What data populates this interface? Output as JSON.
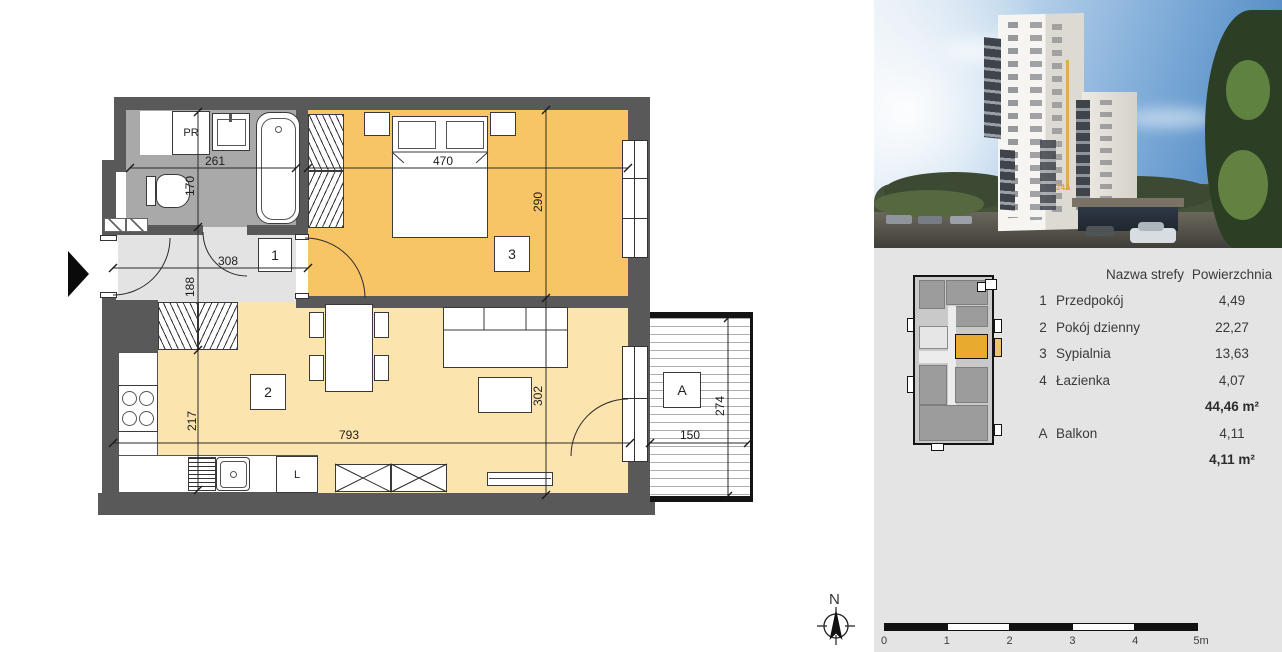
{
  "plan": {
    "dims": {
      "bath_width": "261",
      "bath_depth": "170",
      "bedroom_width": "470",
      "bedroom_depth": "290",
      "hall_width": "308",
      "hall_depth": "188",
      "kitchen_depth": "217",
      "living_width": "793",
      "living_depth": "302",
      "balcony_width": "150",
      "balcony_depth": "274",
      "counter_width": "230"
    },
    "room_labels": {
      "hall": "1",
      "living_room": "2",
      "bedroom": "3",
      "balcony": "A",
      "closet": "PR",
      "fridge": "L"
    },
    "colors": {
      "wall": "#595959",
      "bedroom_floor": "#f7c566",
      "living_floor": "#fce4ae",
      "hall_floor": "#e3e3e3",
      "bathroom_floor": "#a9a9a9"
    }
  },
  "photo": {
    "building_sign": "24A"
  },
  "locator": {
    "highlight_color": "#e9aa30"
  },
  "legend": {
    "header": {
      "name": "Nazwa strefy",
      "area": "Powierzchnia"
    },
    "rows": [
      {
        "num": "1",
        "name": "Przedpokój",
        "area": "4,49"
      },
      {
        "num": "2",
        "name": "Pokój dzienny",
        "area": "22,27"
      },
      {
        "num": "3",
        "name": "Sypialnia",
        "area": "13,63"
      },
      {
        "num": "4",
        "name": "Łazienka",
        "area": "4,07"
      }
    ],
    "apartment_total": "44,46 m²",
    "balcony_row": {
      "num": "A",
      "name": "Balkon",
      "area": "4,11"
    },
    "balcony_total": "4,11 m²"
  },
  "compass": {
    "north_label": "N"
  },
  "scale_bar": {
    "labels": [
      "0",
      "1",
      "2",
      "3",
      "4",
      "5m"
    ]
  }
}
